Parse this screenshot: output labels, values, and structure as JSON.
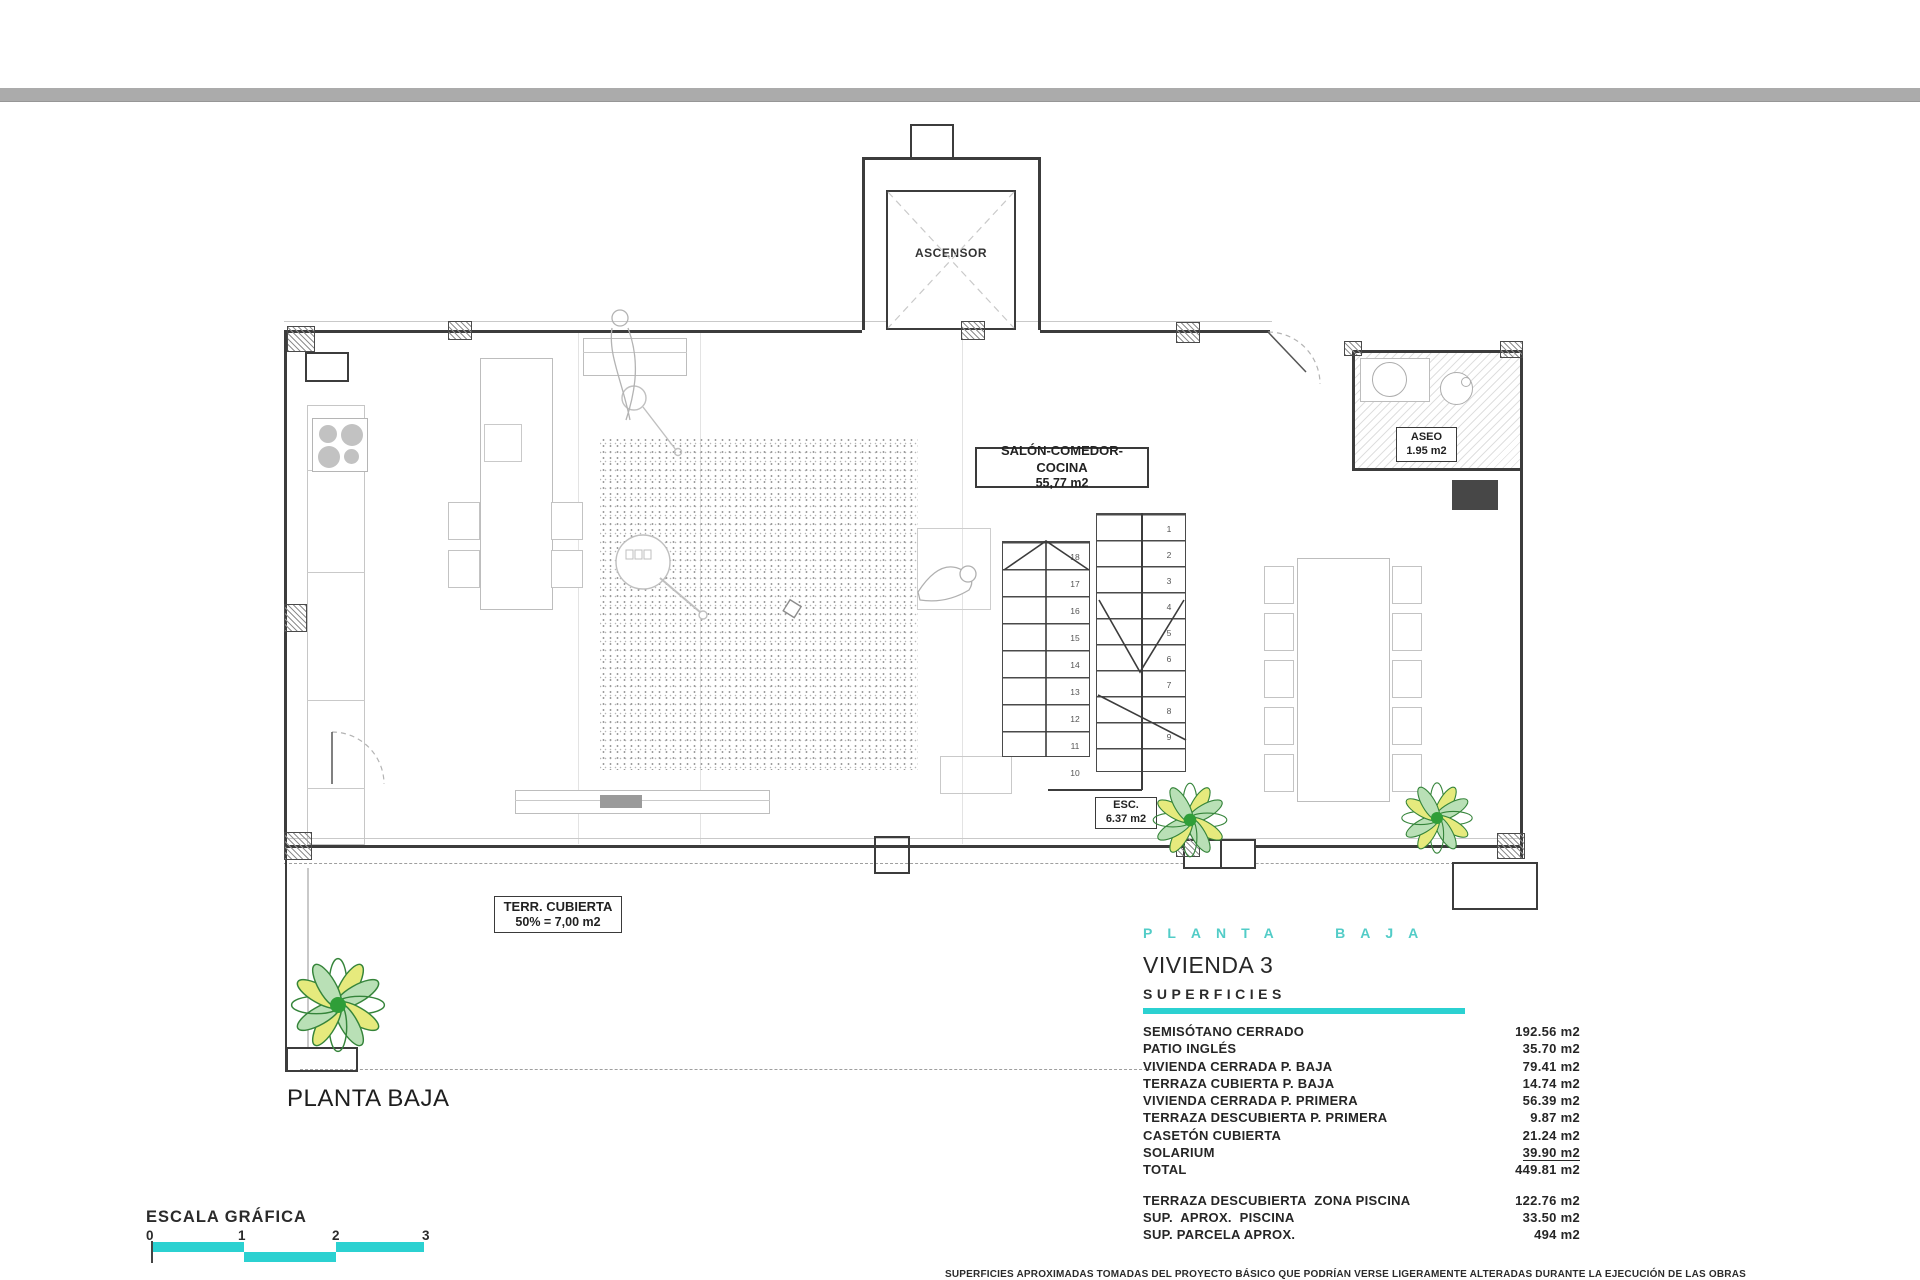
{
  "colors": {
    "accent_teal": "#2bd1d1",
    "title_teal": "#52ccc7",
    "wall": "#3c3c3c",
    "top_bar_gray": "#ababab",
    "plant_green": "#2f9e38",
    "plant_yellow": "#e6ea7d"
  },
  "plan": {
    "elevator_label": "ASCENSOR",
    "salon_label": {
      "line1": "SALÓN-COMEDOR-COCINA",
      "line2": "55,77 m2"
    },
    "aseo_label": {
      "line1": "ASEO",
      "line2": "1.95 m2"
    },
    "esc_label": {
      "line1": "ESC.",
      "line2": "6.37 m2"
    },
    "terraza_label": {
      "line1": "TERR. CUBIERTA",
      "line2": "50% = 7,00 m2"
    },
    "floor_title": "PLANTA BAJA",
    "stairs": {
      "right_numbers": [
        "1",
        "2",
        "3",
        "4",
        "5",
        "6",
        "7",
        "8",
        "9"
      ],
      "left_numbers": [
        "18",
        "17",
        "16",
        "15",
        "14",
        "13",
        "12",
        "11",
        "10"
      ]
    }
  },
  "panel": {
    "title": "PLANTA BAJA",
    "subtitle": "VIVIENDA 3",
    "section": "SUPERFICIES",
    "rows": [
      {
        "label": "SEMISÓTANO CERRADO",
        "value": "192.56 m2"
      },
      {
        "label": "PATIO INGLÉS",
        "value": "35.70 m2"
      },
      {
        "label": "VIVIENDA CERRADA P. BAJA",
        "value": "79.41 m2"
      },
      {
        "label": "TERRAZA CUBIERTA P. BAJA",
        "value": "14.74 m2"
      },
      {
        "label": "VIVIENDA CERRADA P. PRIMERA",
        "value": "56.39 m2"
      },
      {
        "label": "TERRAZA DESCUBIERTA P. PRIMERA",
        "value": "9.87 m2"
      },
      {
        "label": "CASETÓN CUBIERTA",
        "value": "21.24 m2"
      },
      {
        "label": "SOLARIUM",
        "value": "39.90 m2",
        "underline": true
      },
      {
        "label": "TOTAL",
        "value": "449.81 m2"
      }
    ],
    "rows2": [
      {
        "label": "TERRAZA DESCUBIERTA  ZONA PISCINA",
        "value": "122.76 m2"
      },
      {
        "label": "SUP.  APROX.  PISCINA",
        "value": "33.50 m2"
      },
      {
        "label": "SUP. PARCELA APROX.",
        "value": "494 m2"
      }
    ]
  },
  "scale": {
    "label": "ESCALA GRÁFICA",
    "ticks": [
      "0",
      "1",
      "2",
      "3"
    ]
  },
  "footer": {
    "disclaimer": "SUPERFICIES APROXIMADAS TOMADAS DEL PROYECTO BÁSICO QUE PODRÍAN VERSE LIGERAMENTE ALTERADAS DURANTE LA EJECUCIÓN DE LAS OBRAS"
  }
}
